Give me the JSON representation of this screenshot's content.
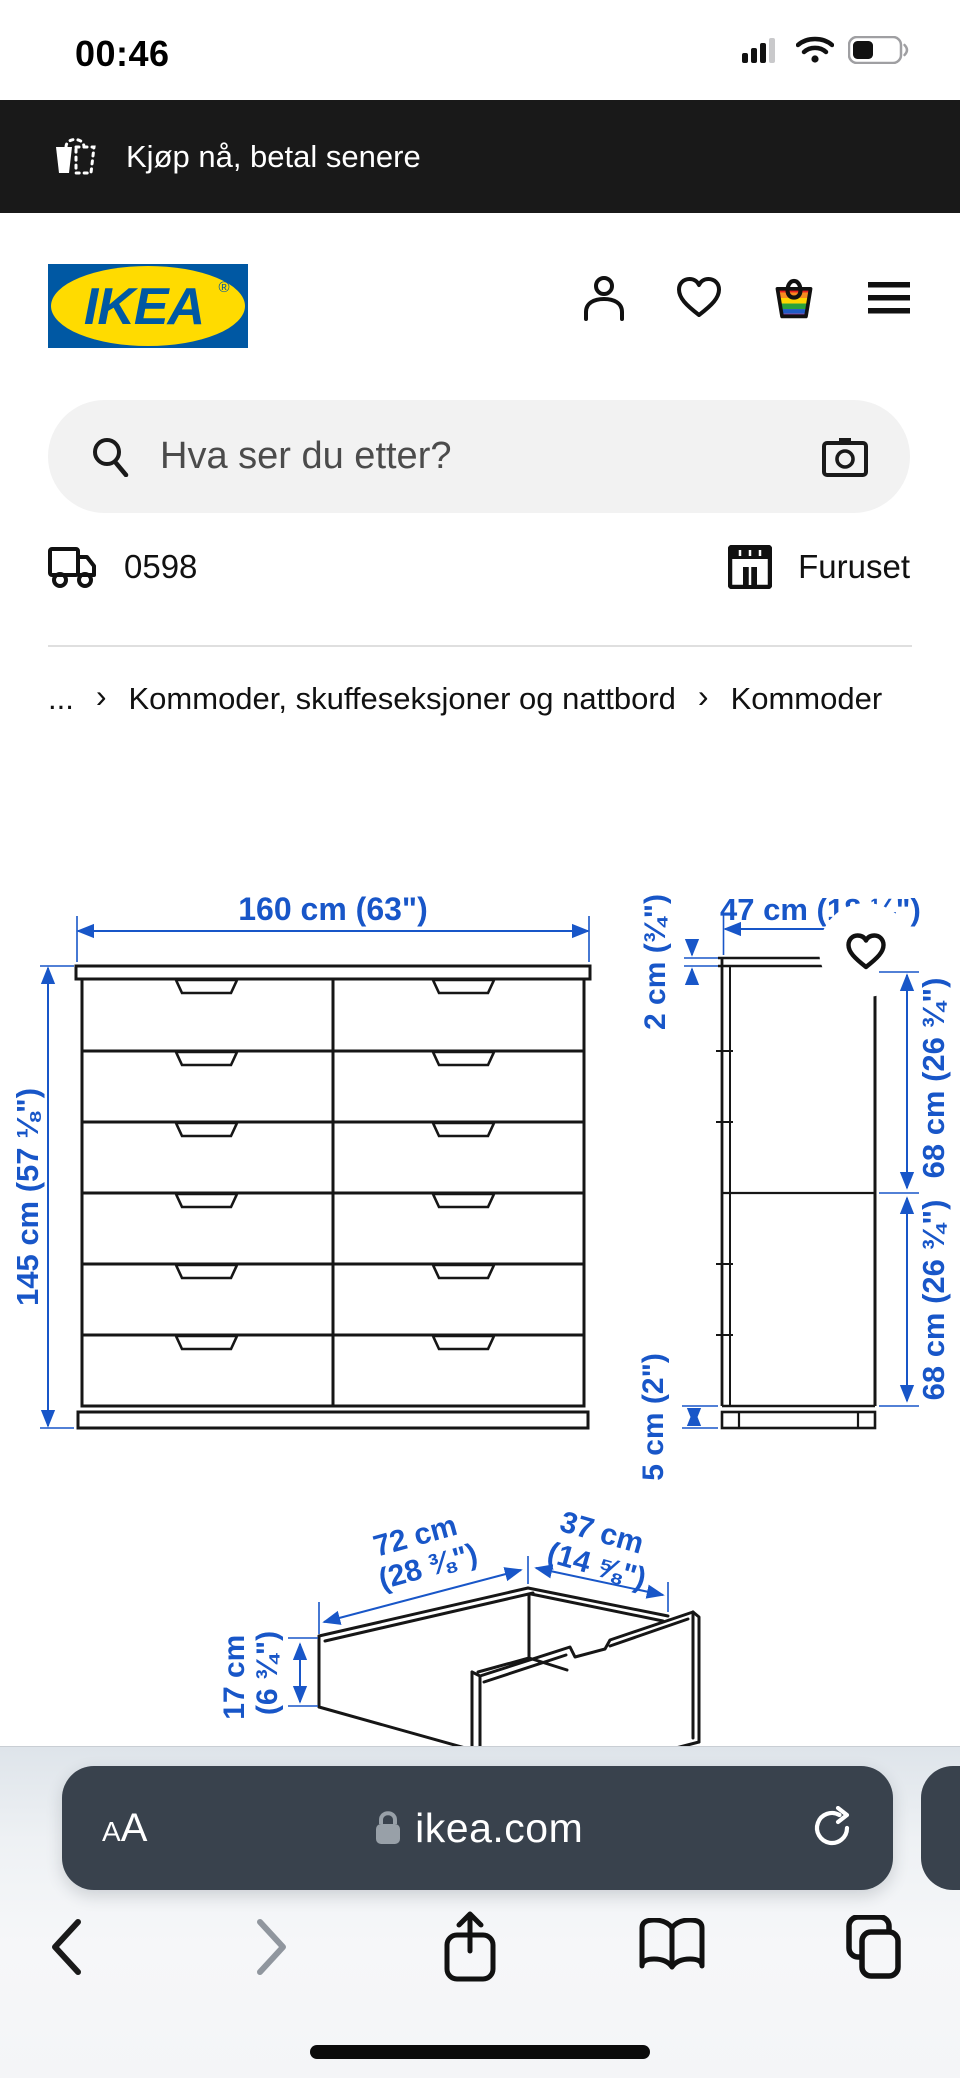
{
  "status_bar": {
    "time": "00:46"
  },
  "promo_banner": {
    "text": "Kjøp nå, betal senere"
  },
  "header": {
    "logo_text": "IKEA",
    "registered_mark": "®"
  },
  "search": {
    "placeholder": "Hva ser du etter?"
  },
  "location_bar": {
    "postcode": "0598",
    "store": "Furuset"
  },
  "breadcrumb": {
    "ellipsis": "...",
    "separator": "›",
    "items": [
      "Kommoder, skuffeseksjoner og nattbord",
      "Kommoder"
    ]
  },
  "diagram": {
    "accent_color": "#1856c8",
    "front_view": {
      "width_label": "160 cm (63\")",
      "height_label": "145 cm (57 ⅛\")"
    },
    "side_view": {
      "depth_label": "47 cm (18 ¼\")",
      "top_thickness_label": "2 cm (¾\")",
      "upper_section_label": "68 cm (26 ¾\")",
      "lower_section_label": "68 cm (26 ¾\")",
      "plinth_label": "5 cm (2\")"
    },
    "drawer_view": {
      "width_cm": "72 cm",
      "width_in": "(28 ⅜\")",
      "depth_cm": "37 cm",
      "depth_in": "(14 ⅝\")",
      "height_cm": "17 cm",
      "height_in": "(6 ¾\")"
    }
  },
  "browser": {
    "text_size_label_small": "A",
    "text_size_label_large": "A",
    "url": "ikea.com"
  }
}
